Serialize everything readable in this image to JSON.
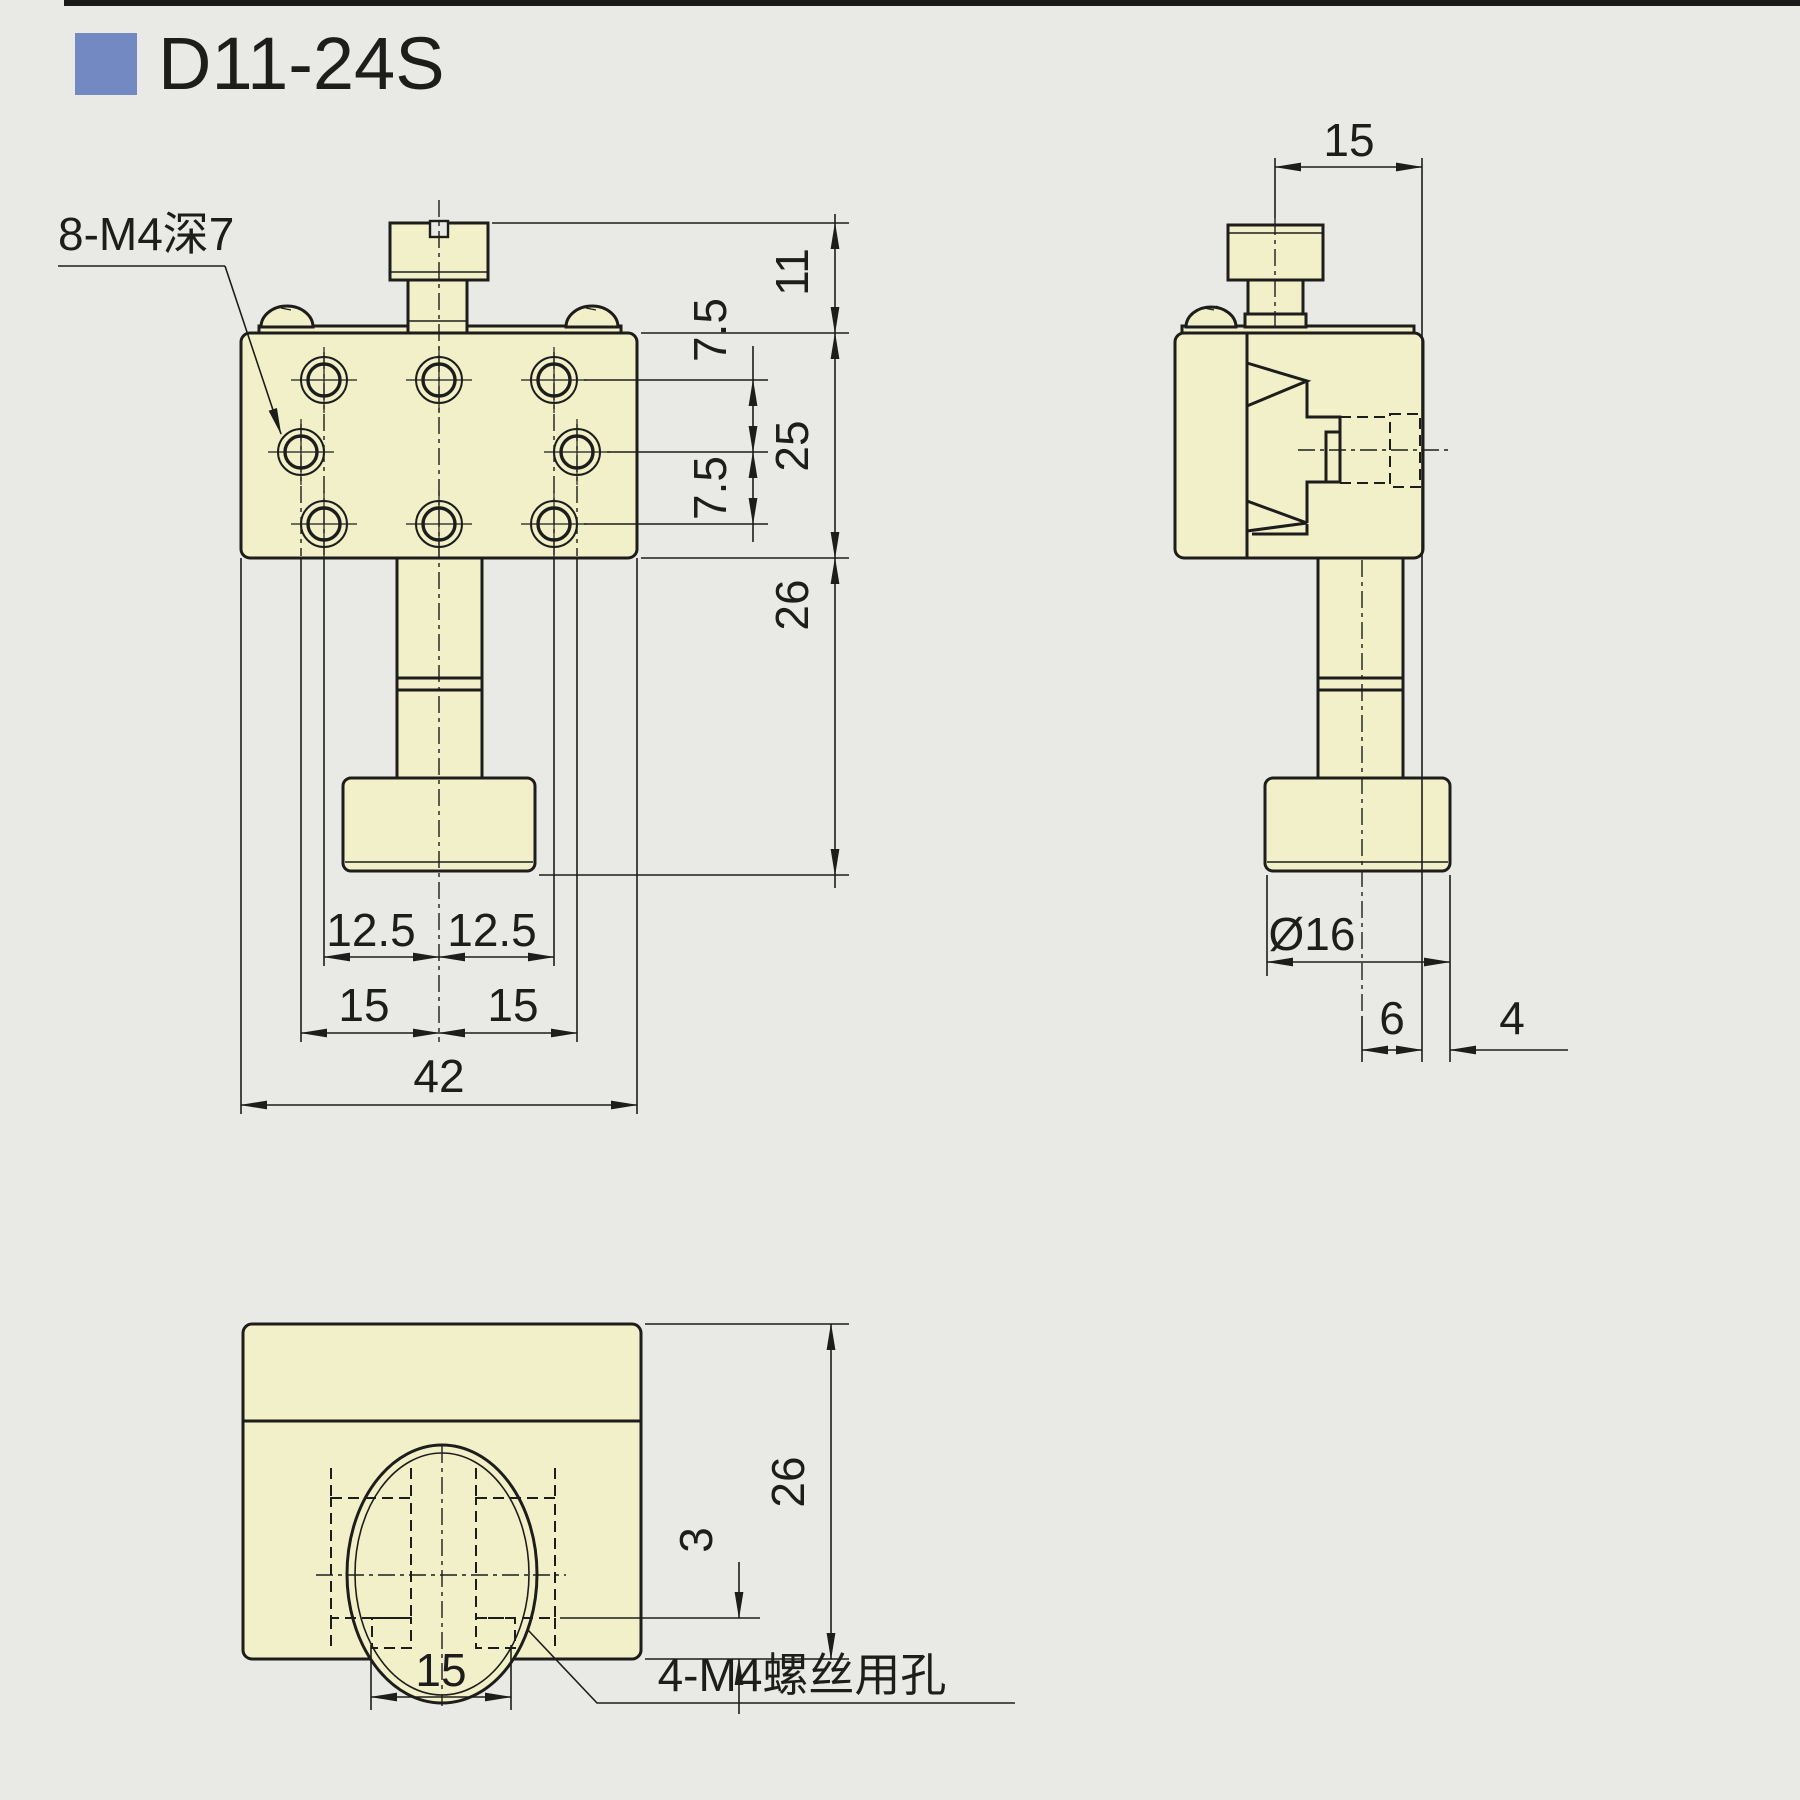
{
  "header": {
    "title": "D11-24S"
  },
  "colors": {
    "background": "#e9e9e6",
    "part_fill": "#f2f0c9",
    "line": "#1d1d1b",
    "accent_blue": "#7289c2",
    "top_bar": "#1a1a1a"
  },
  "views": {
    "front": {
      "callout": "8-M4深7",
      "dims": {
        "screw_height": "11",
        "hole_row_pitch_upper": "7.5",
        "body_height": "25",
        "hole_row_pitch_lower": "7.5",
        "post_length": "26",
        "hole_offset_left": "12.5",
        "hole_offset_right": "12.5",
        "hole_pitch_left": "15",
        "hole_pitch_right": "15",
        "overall_width": "42"
      }
    },
    "side": {
      "dims": {
        "screw_to_edge": "15",
        "knob_diameter": "Ø16",
        "center_to_edge": "6",
        "edge_to_knob": "4"
      }
    },
    "bottom": {
      "callout": "4-M4螺丝用孔",
      "dims": {
        "body_depth": "26",
        "slot_edge_offset": "3",
        "slot_pitch": "15"
      }
    }
  }
}
